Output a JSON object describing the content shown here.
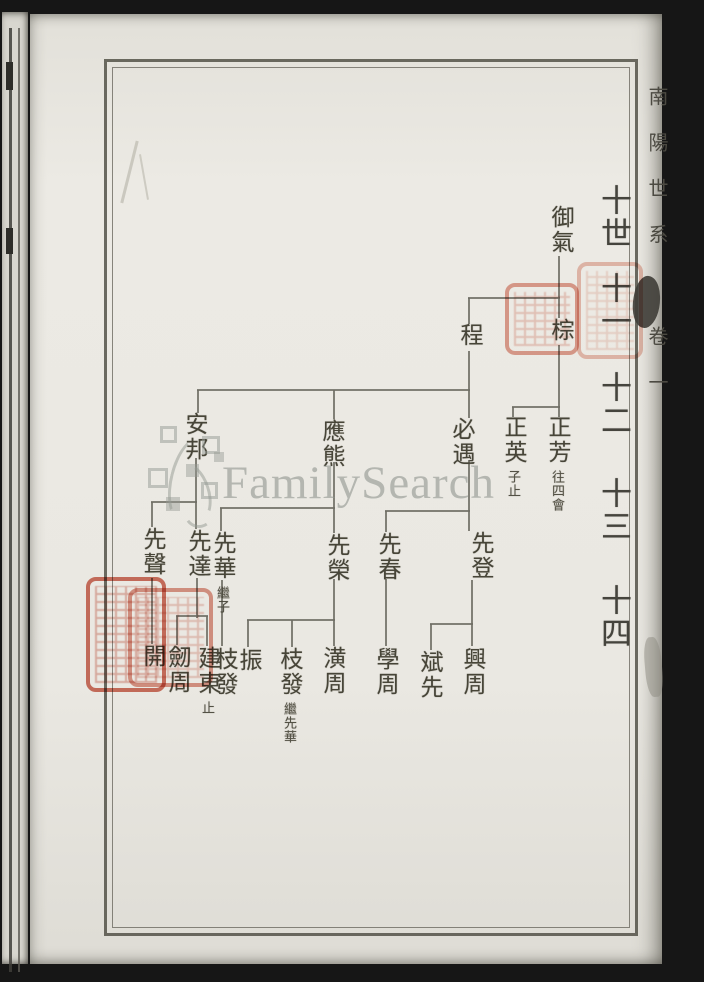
{
  "document": {
    "margin_title": "南陽世系",
    "volume_label": "卷一",
    "watermark_text": "FamilySearch"
  },
  "generation_labels": [
    {
      "label": "十世",
      "x": 608,
      "y": 184
    },
    {
      "label": "十一",
      "x": 608,
      "y": 272
    },
    {
      "label": "十二",
      "x": 608,
      "y": 371
    },
    {
      "label": "十三",
      "x": 608,
      "y": 477
    },
    {
      "label": "十四",
      "x": 608,
      "y": 584
    }
  ],
  "tree": {
    "nodes": [
      {
        "name": "御氣",
        "x": 560,
        "y": 205
      },
      {
        "name": "棕",
        "x": 560,
        "y": 318
      },
      {
        "name": "程",
        "x": 469,
        "y": 323
      },
      {
        "name": "正芳",
        "note": "往四會",
        "x": 557,
        "y": 415
      },
      {
        "name": "正英",
        "note": "子止",
        "x": 513,
        "y": 415
      },
      {
        "name": "必遇",
        "x": 461,
        "y": 417
      },
      {
        "name": "應熊",
        "x": 331,
        "y": 419
      },
      {
        "name": "安邦",
        "x": 194,
        "y": 412
      },
      {
        "name": "先登",
        "x": 480,
        "y": 531
      },
      {
        "name": "先春",
        "x": 387,
        "y": 532
      },
      {
        "name": "先榮",
        "x": 336,
        "y": 533
      },
      {
        "name": "先華",
        "note": "繼子",
        "x": 222,
        "y": 531
      },
      {
        "name": "先達",
        "x": 197,
        "y": 529
      },
      {
        "name": "先聲",
        "x": 152,
        "y": 527
      },
      {
        "name": "興周",
        "x": 472,
        "y": 647
      },
      {
        "name": "斌先",
        "x": 429,
        "y": 650
      },
      {
        "name": "學周",
        "x": 385,
        "y": 647
      },
      {
        "name": "潢周",
        "x": 332,
        "y": 646
      },
      {
        "name": "枝發",
        "note": "繼先華",
        "x": 289,
        "y": 647
      },
      {
        "name": "振",
        "x": 248,
        "y": 648
      },
      {
        "name": "枝發",
        "x": 224,
        "y": 647
      },
      {
        "name": "建東",
        "note": "止",
        "x": 207,
        "y": 646
      },
      {
        "name": "劒周",
        "x": 177,
        "y": 645
      },
      {
        "name": "開",
        "x": 152,
        "y": 644
      }
    ],
    "lineage": [
      "御氣 → 棕、程",
      "棕 → 正芳、正英",
      "程 → 必遇、應熊、安邦",
      "必遇 → 先登、先春",
      "應熊 → 先榮、先華",
      "安邦 → 先達、先聲",
      "先登 → 興周、斌先",
      "先春 → 學周",
      "先榮 → 潢周、枝發、振",
      "先華 → 枝發",
      "先達 → 建東、劒周",
      "先聲 → 開"
    ],
    "connectors": [
      {
        "x": 558,
        "y": 256,
        "w": 2,
        "h": 62
      },
      {
        "x": 558,
        "y": 345,
        "w": 2,
        "h": 72
      },
      {
        "x": 468,
        "y": 297,
        "w": 92,
        "h": 2
      },
      {
        "x": 468,
        "y": 298,
        "w": 2,
        "h": 26
      },
      {
        "x": 512,
        "y": 406,
        "w": 48,
        "h": 2
      },
      {
        "x": 512,
        "y": 407,
        "w": 2,
        "h": 10
      },
      {
        "x": 468,
        "y": 351,
        "w": 2,
        "h": 67
      },
      {
        "x": 197,
        "y": 389,
        "w": 273,
        "h": 2
      },
      {
        "x": 197,
        "y": 390,
        "w": 2,
        "h": 23
      },
      {
        "x": 333,
        "y": 390,
        "w": 2,
        "h": 29
      },
      {
        "x": 468,
        "y": 460,
        "w": 2,
        "h": 71
      },
      {
        "x": 385,
        "y": 510,
        "w": 85,
        "h": 2
      },
      {
        "x": 385,
        "y": 511,
        "w": 2,
        "h": 21
      },
      {
        "x": 333,
        "y": 462,
        "w": 2,
        "h": 71
      },
      {
        "x": 220,
        "y": 507,
        "w": 115,
        "h": 2
      },
      {
        "x": 220,
        "y": 508,
        "w": 2,
        "h": 23
      },
      {
        "x": 195,
        "y": 458,
        "w": 2,
        "h": 71
      },
      {
        "x": 151,
        "y": 501,
        "w": 46,
        "h": 2
      },
      {
        "x": 151,
        "y": 502,
        "w": 2,
        "h": 25
      },
      {
        "x": 471,
        "y": 580,
        "w": 2,
        "h": 66
      },
      {
        "x": 430,
        "y": 623,
        "w": 43,
        "h": 2
      },
      {
        "x": 430,
        "y": 624,
        "w": 2,
        "h": 26
      },
      {
        "x": 385,
        "y": 579,
        "w": 2,
        "h": 67
      },
      {
        "x": 333,
        "y": 579,
        "w": 2,
        "h": 67
      },
      {
        "x": 247,
        "y": 619,
        "w": 88,
        "h": 2
      },
      {
        "x": 247,
        "y": 620,
        "w": 2,
        "h": 27
      },
      {
        "x": 291,
        "y": 620,
        "w": 2,
        "h": 27
      },
      {
        "x": 221,
        "y": 580,
        "w": 2,
        "h": 66
      },
      {
        "x": 196,
        "y": 578,
        "w": 2,
        "h": 40
      },
      {
        "x": 176,
        "y": 615,
        "w": 32,
        "h": 2
      },
      {
        "x": 176,
        "y": 616,
        "w": 2,
        "h": 29
      },
      {
        "x": 206,
        "y": 616,
        "w": 2,
        "h": 30
      },
      {
        "x": 151,
        "y": 578,
        "w": 2,
        "h": 66
      }
    ]
  },
  "seals": [
    {
      "x": 505,
      "y": 283,
      "w": 74,
      "h": 72,
      "color": "#dd8672",
      "opacity": 0.75
    },
    {
      "x": 577,
      "y": 262,
      "w": 66,
      "h": 97,
      "color": "#e39a88",
      "opacity": 0.6
    },
    {
      "x": 86,
      "y": 577,
      "w": 80,
      "h": 115,
      "color": "#cc5c49",
      "opacity": 0.85
    },
    {
      "x": 128,
      "y": 588,
      "w": 85,
      "h": 99,
      "color": "#d4705c",
      "opacity": 0.7
    }
  ],
  "watermark": {
    "squares": [
      {
        "x": 160,
        "y": 426,
        "s": 17,
        "style": "outline"
      },
      {
        "x": 202,
        "y": 436,
        "s": 18,
        "style": "outline"
      },
      {
        "x": 148,
        "y": 468,
        "s": 20,
        "style": "outline"
      },
      {
        "x": 186,
        "y": 464,
        "s": 13,
        "style": "fill"
      },
      {
        "x": 201,
        "y": 482,
        "s": 17,
        "style": "outline"
      },
      {
        "x": 166,
        "y": 497,
        "s": 14,
        "style": "fill"
      },
      {
        "x": 214,
        "y": 452,
        "s": 10,
        "style": "fill"
      }
    ]
  },
  "colors": {
    "ink": "#474538",
    "line": "#6f6d64",
    "paper": "#e9e7e1",
    "seal_red": "#cc5c49",
    "watermark_gray": "#949a93",
    "background": "#161616"
  }
}
